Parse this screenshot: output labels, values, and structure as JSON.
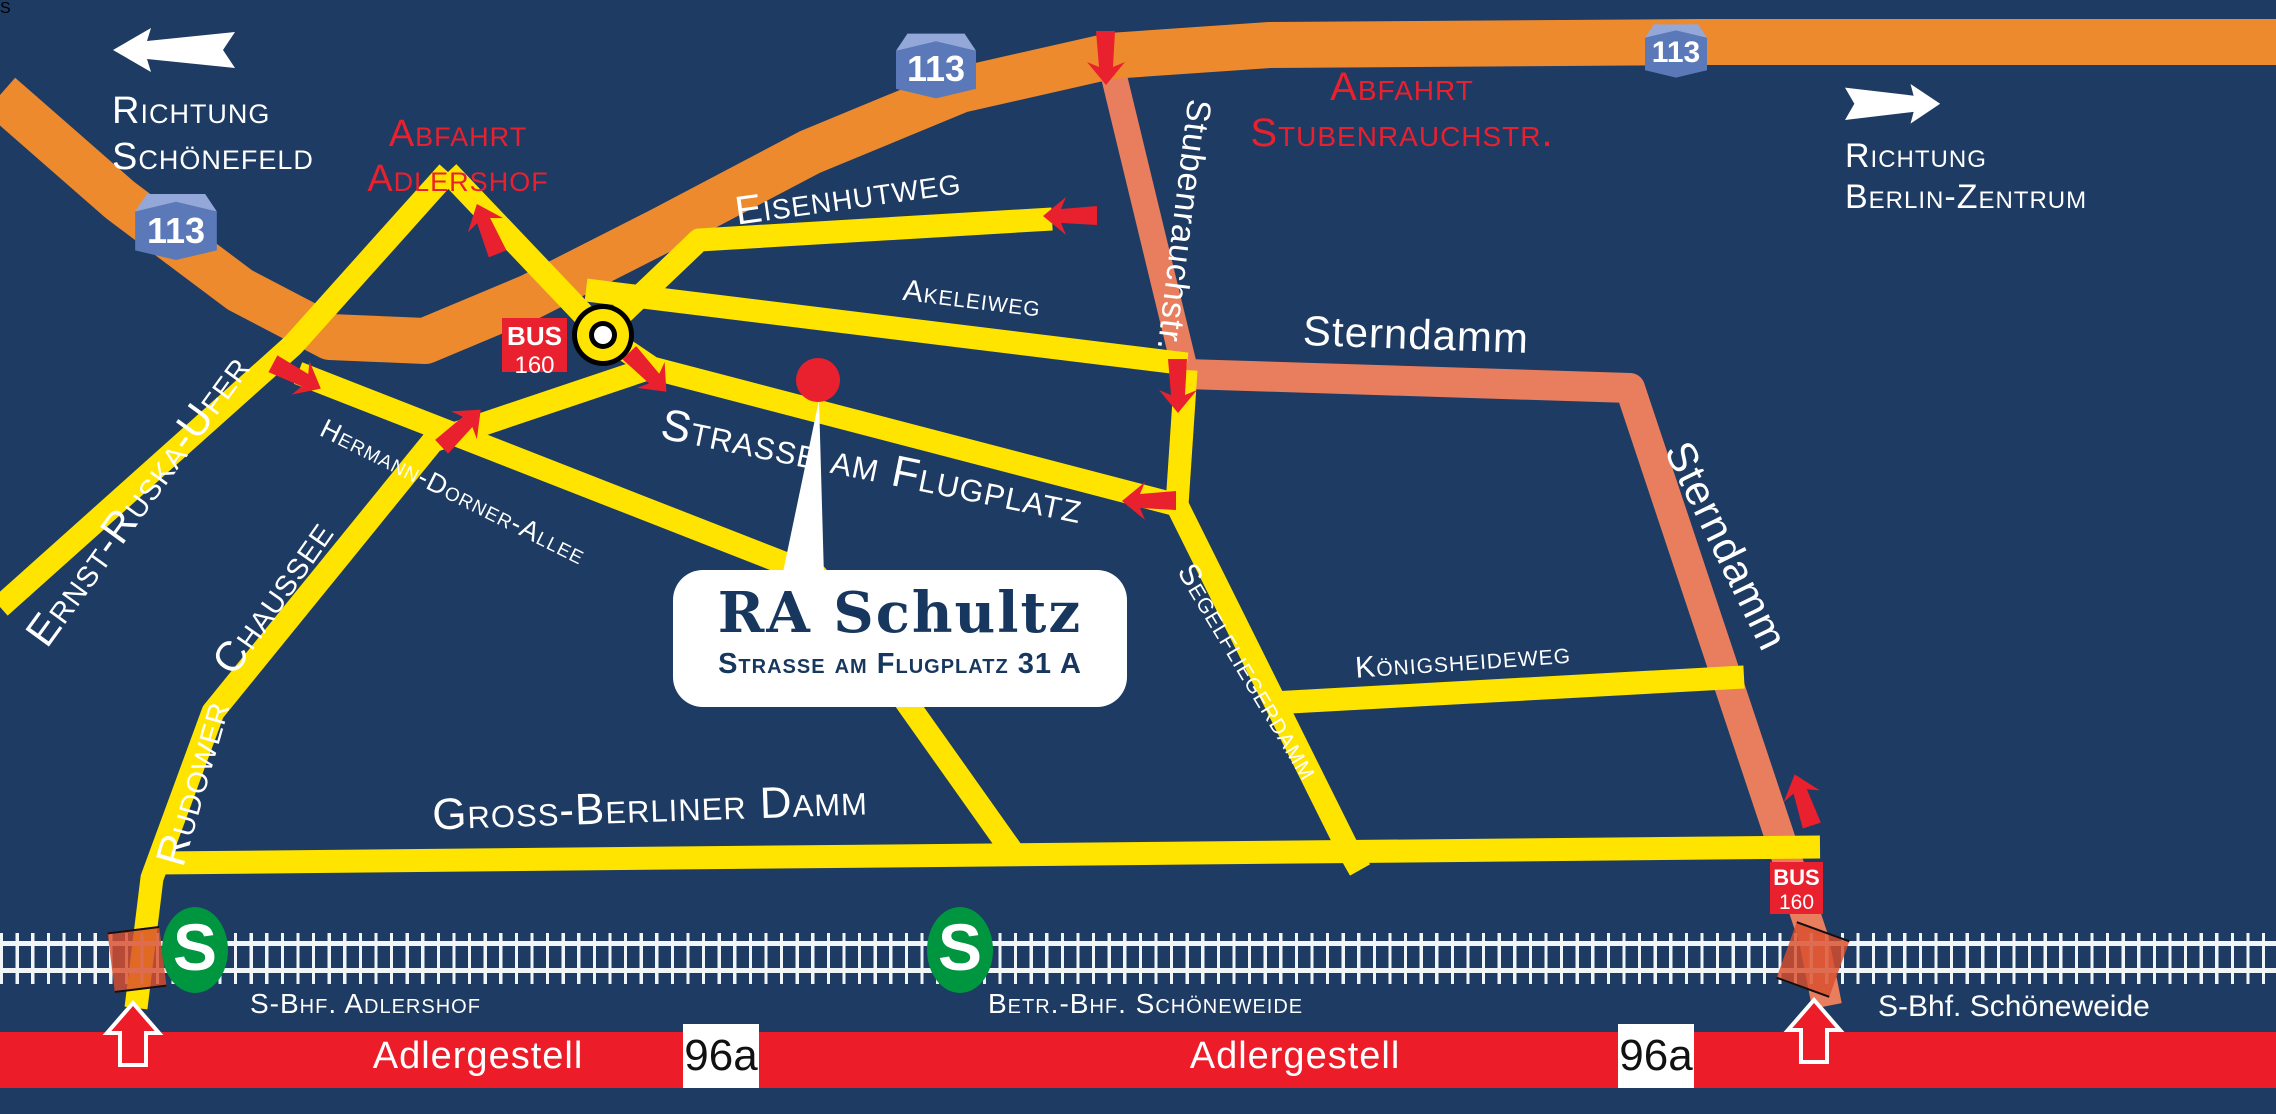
{
  "map": {
    "callout": {
      "name": "RA Schultz",
      "address": "Strasse am Flugplatz 31 A"
    },
    "motorway_shield": "113",
    "directions": {
      "schoenefeld_line1": "Richtung",
      "schoenefeld_line2": "Schönefeld",
      "berlin_line1": "Richtung",
      "berlin_line2": "Berlin-Zentrum"
    },
    "exits": {
      "adlershof_line1": "Abfahrt",
      "adlershof_line2": "Adlershof",
      "stubenrauch_line1": "Abfahrt",
      "stubenrauch_line2": "Stubenrauchstr."
    },
    "streets": {
      "eisenhutweg": "Eisenhutweg",
      "akeleiweg": "Akeleiweg",
      "strasse_am_flugplatz": "Strasse am Flugplatz",
      "hermann_dorner_allee": "Hermann-Dorner-Allee",
      "ernst_ruska_ufer": "Ernst-Ruska-Ufer",
      "rudower_chaussee_1": "Rudower",
      "rudower_chaussee_2": "Chaussee",
      "gross_berliner_damm": "Gross-Berliner Damm",
      "segelfliegerdamm": "Segelfliegerdamm",
      "koenigsheideweg": "Königsheideweg",
      "sterndamm": "Sterndamm",
      "stubenrauchstr": "Stubenrauchstr.",
      "adlergestell": "Adlergestell"
    },
    "bus": {
      "label": "BUS",
      "line": "160"
    },
    "route_number": "96a",
    "sbahn_letter": "S",
    "stations": {
      "adlershof": "S-Bhf. Adlershof",
      "betriebsbahnhof": "Betr.-Bhf. Schöneweide",
      "schoeneweide": "S-Bhf. Schöneweide"
    }
  },
  "colors": {
    "navy": "#1d3b63",
    "orange": "#ee8a2e",
    "yellow": "#ffe400",
    "salmon": "#e87e5d",
    "red": "#e9202e",
    "bandred": "#ed1c29",
    "green": "#00953f",
    "shieldface": "#5b79b8",
    "shieldlid": "#93a8d8",
    "ink": "#17375e",
    "white": "#ffffff"
  }
}
